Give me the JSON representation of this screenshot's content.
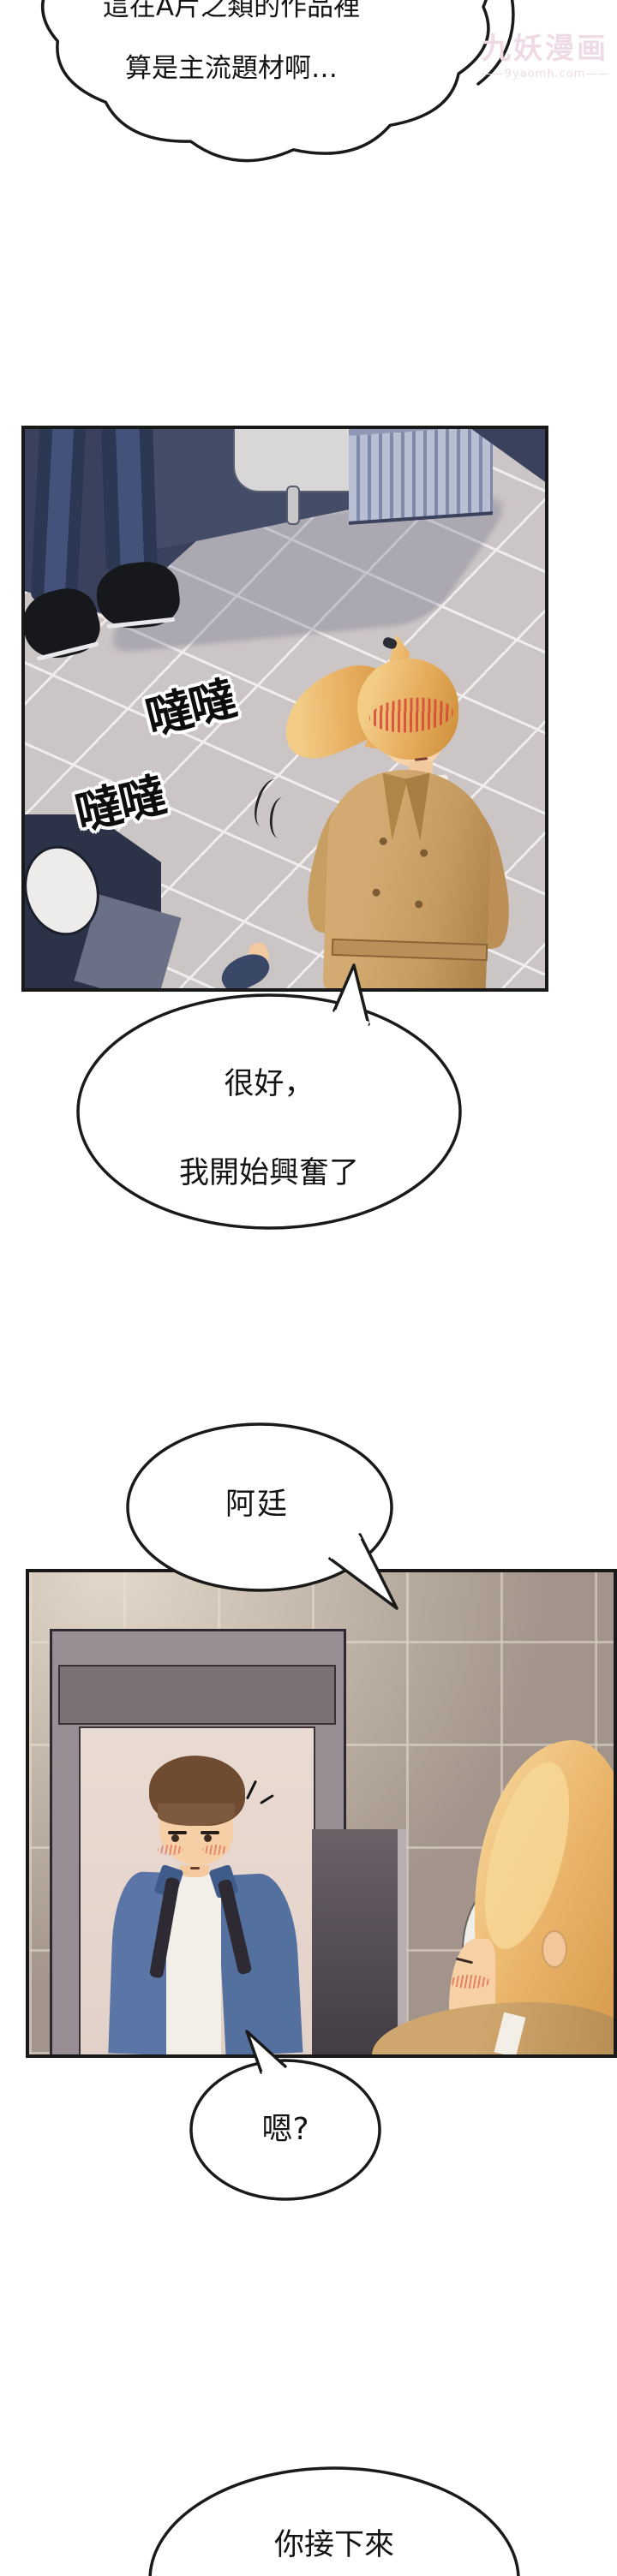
{
  "watermark": {
    "name": "九妖漫画",
    "url": "——9yaomh.com——"
  },
  "bubbles": {
    "b1": {
      "line1": "這在A片之類的作品裡",
      "line2": "算是主流題材啊…"
    },
    "b2": {
      "line1": "很好，",
      "line2": "我開始興奮了"
    },
    "b3": {
      "line1": "阿廷"
    },
    "b4": {
      "line1": "嗯?"
    },
    "b5": {
      "line1": "你接下來",
      "line2": "要怎麼做?"
    }
  },
  "sfx": {
    "footsteps_a": "噠噠",
    "footsteps_b": "噠噠"
  }
}
